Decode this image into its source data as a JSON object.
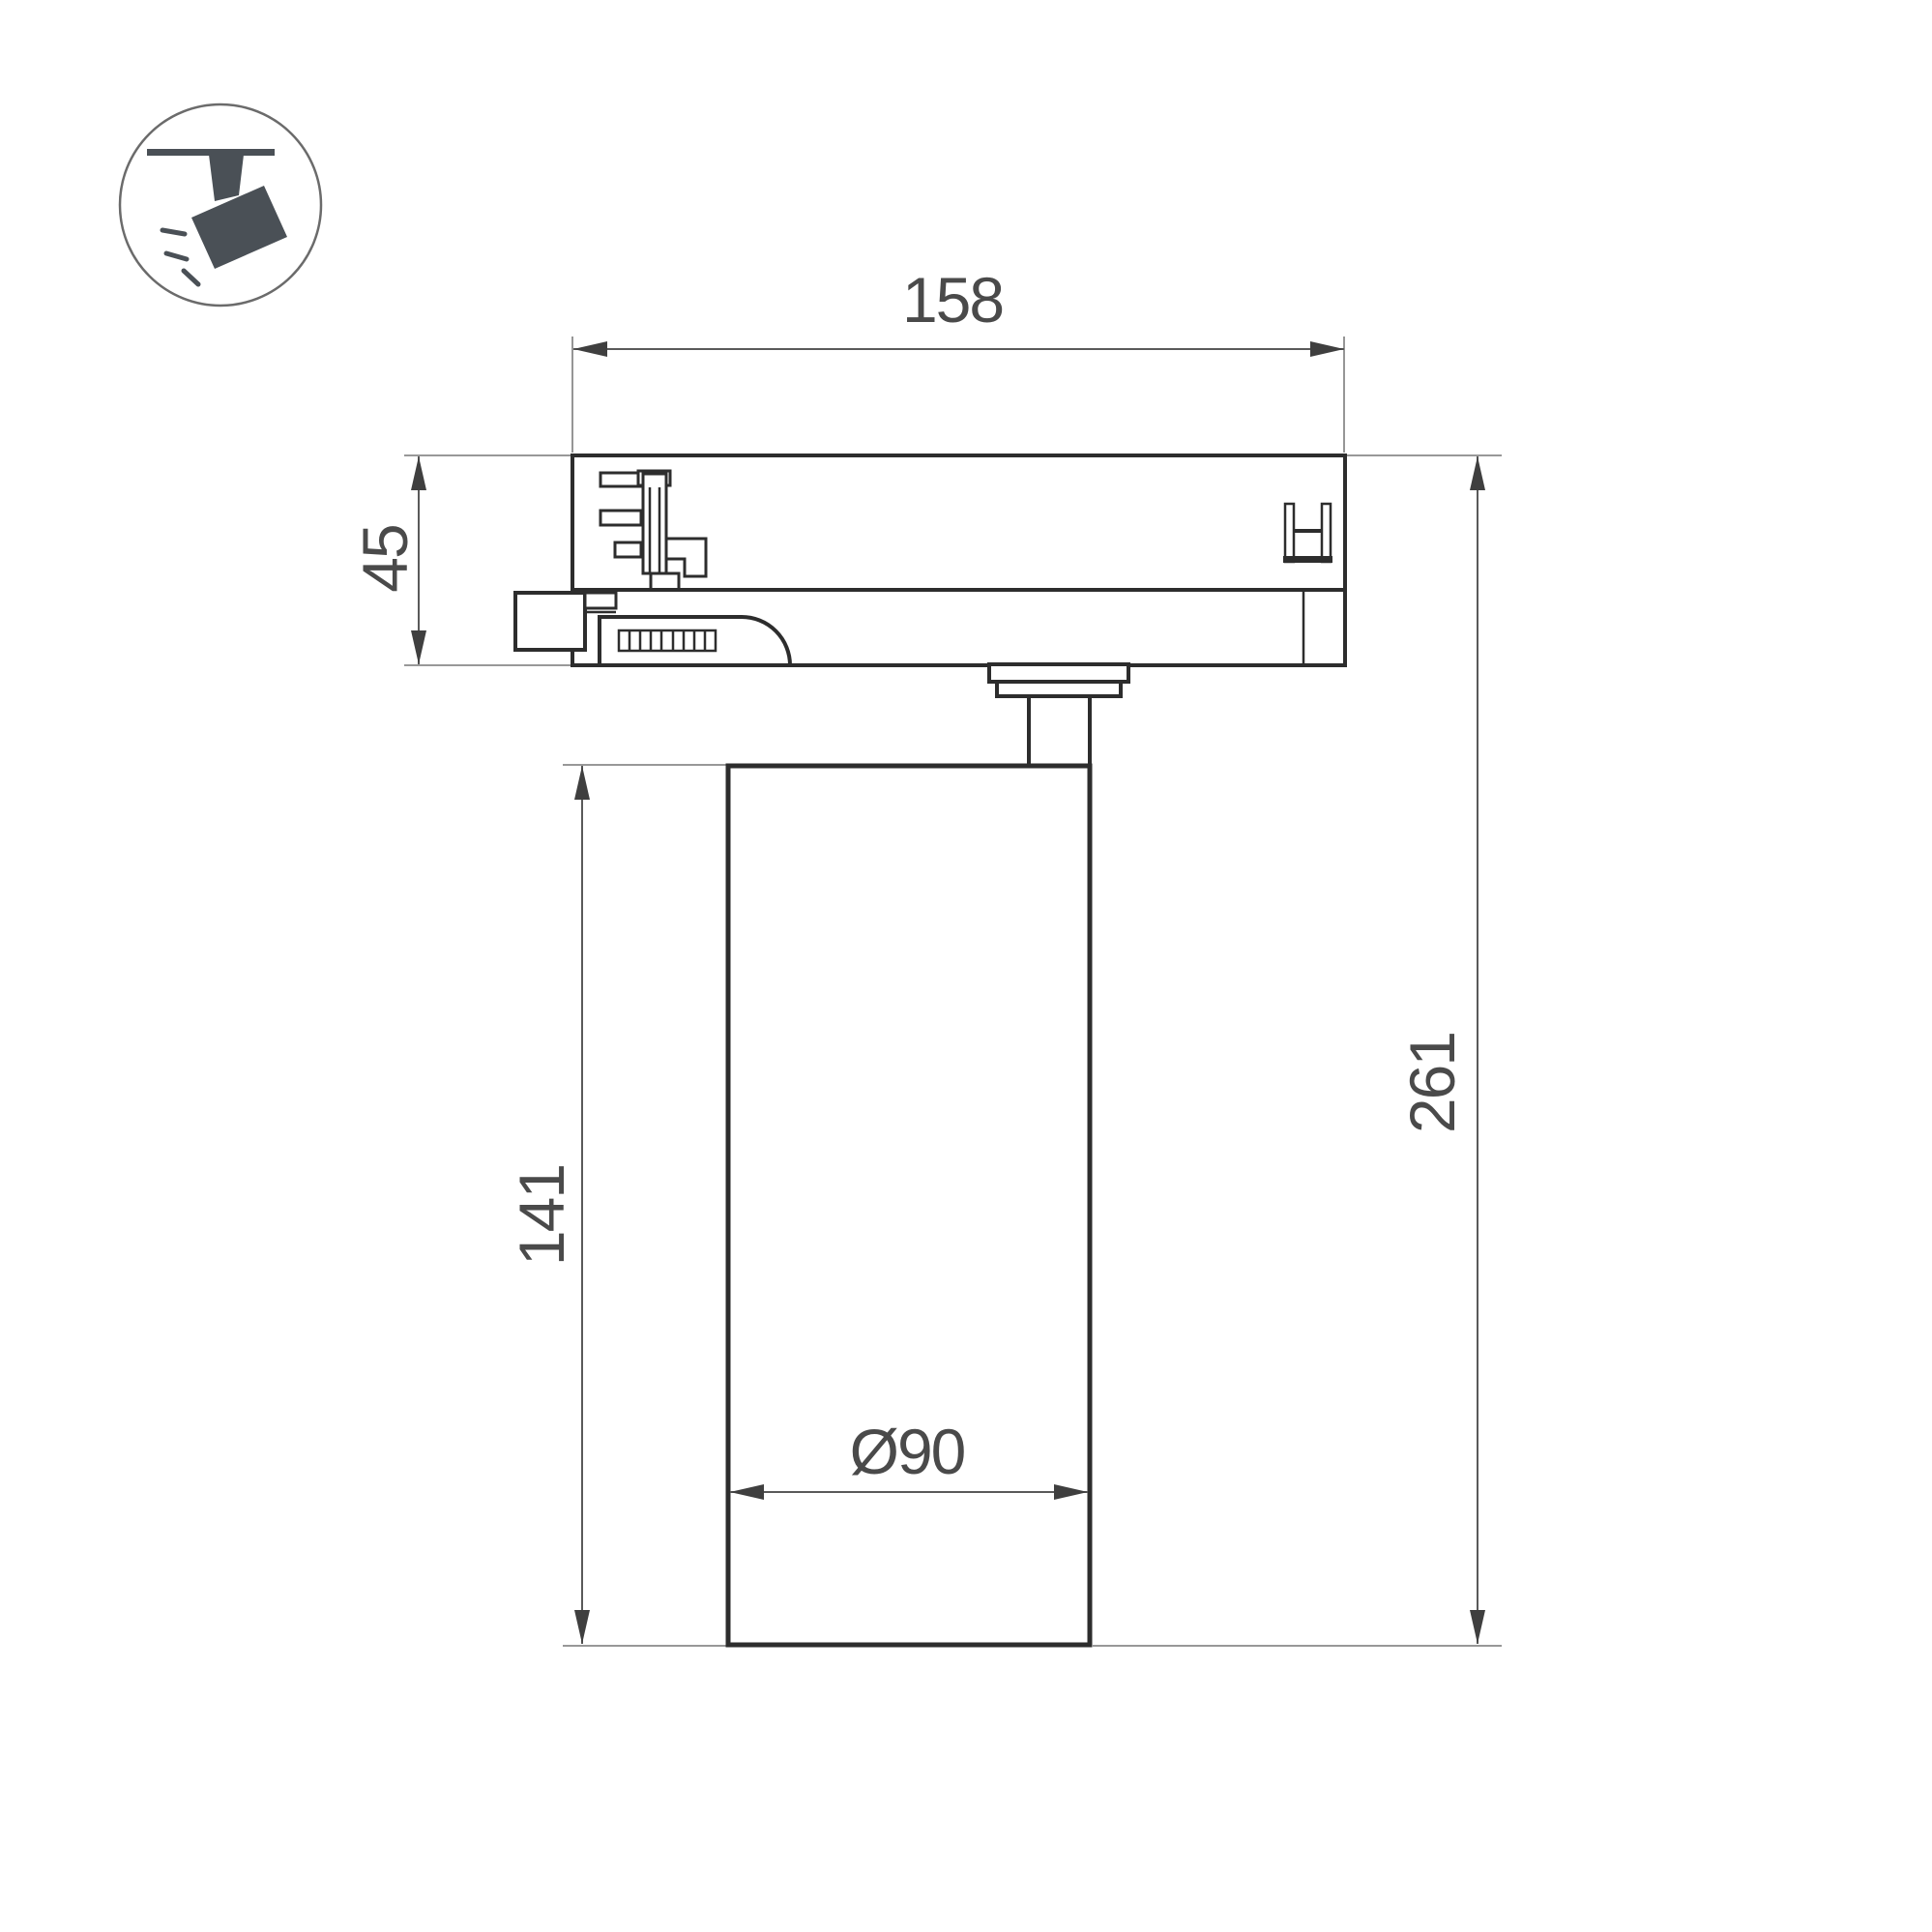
{
  "page": {
    "background": "#ffffff"
  },
  "icon": {
    "name": "track-mounted-spotlight",
    "color": "#4a5056",
    "circle_stroke": "#6b6b6b"
  },
  "drawing": {
    "outline_color": "#2d2d2d",
    "dimension_line_color": "#5a5a5a",
    "extension_line_color": "#8a8a8a",
    "text_color": "#4a4a4a",
    "dimensions": {
      "track_adapter_width": {
        "label": "158"
      },
      "track_adapter_height": {
        "label": "45"
      },
      "lamp_body_height": {
        "label": "141"
      },
      "total_height": {
        "label": "261"
      },
      "lamp_body_diameter": {
        "label": "Ø90"
      }
    }
  }
}
